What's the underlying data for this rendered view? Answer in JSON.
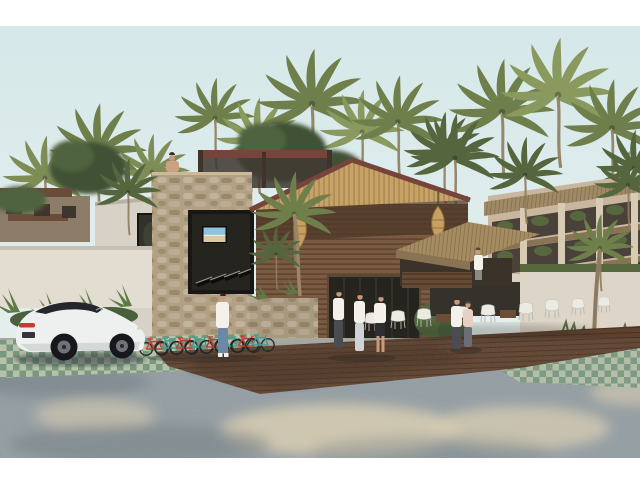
{
  "scene": {
    "type": "3d-architectural-rendering",
    "setting": "Tropical boutique hotel and condo complex amid a dense coconut palm grove",
    "elements": {
      "sky": "pale hazy blue sky",
      "vegetation": "coconut palm canopy behind and around all buildings, two broadleaf trees",
      "background_building": "multi-storey condo with thatched roof bands and planted balconies on the right",
      "gym_building": "white concrete volume on the left with tall dark glass and gym equipment visible inside",
      "stone_tower": "rough stone-clad volume with a dark picture window showing treadmills and a wall TV playing a beach scene; rooftop pergola with a seated person",
      "entrance_pavilion": "gabled palapa-style lobby with bamboo ceiling, maroon fascia, dark timber slat walls and two wicker pendant lamps",
      "terrace": "thatched palapa deck with timber railing and a standing figure",
      "dining_area": "row of white woven chairs and low tables on a timber deck",
      "car": "white Porsche 911-style coupe parked on green grass pavers",
      "bicycles": "rack of alternating red and turquoise bicycles along the stone wall",
      "people": "rooftop lounger, cyclist at the bike rack, three guests walking near the entrance, embracing couple on the deck, terrace observer",
      "ground": "grey gravel forecourt, turquoise-green grass-paver grid and chocolate timber deck with dappled tree shadows"
    },
    "counts": {
      "bicycles": 8,
      "lounge_chairs": 9,
      "people": 8,
      "cars": 1
    },
    "framing": {
      "letterbox": "white bars top and bottom",
      "content_top_px": 26,
      "content_bottom_px": 458
    }
  },
  "palette": {
    "letterbox": "#ffffff",
    "sky_top": "#d6e8ea",
    "sky_bottom": "#e9f1ee",
    "palm_light": "#8a9a5e",
    "palm_mid": "#6f7f4b",
    "palm_dark": "#55663e",
    "palm_back": "#7e8c55",
    "leaf_dark": "#3f5136",
    "leaf_mid": "#4f6340",
    "condo_wall": "#c8b69e",
    "thatch": "#a08a66",
    "thatch_dark": "#8a7352",
    "concrete": "#d8d2c6",
    "concrete_low": "#e3ddd1",
    "stone": "#b2a083",
    "stone_planter": "#a8997d",
    "glass": "#26241f",
    "gym_glass": "#33312b",
    "roof_fascia": "#76443a",
    "bamboo": "#c8a368",
    "wood_slat": "#7a5a41",
    "wood_dark": "#4e382a",
    "lamp": "#c79f5f",
    "palapa_thatch": "#a58c62",
    "deck": "#5e412d",
    "paver_light": "#b7c2a6",
    "paver_green": "#2f6a52",
    "gravel_light": "#a9aba1",
    "gravel": "#939da2",
    "gravel_shadow": "#6e7a82",
    "sand": "#dbcfb1",
    "car_body": "#eef0ef",
    "car_glass": "#23262b",
    "taillight": "#c63a33",
    "tire": "#17181b",
    "bike_red": "#c23f33",
    "bike_teal": "#3ea08f",
    "skin": "#c89a7c",
    "jeans": "#6d87a5",
    "white_cloth": "#f3f1ea",
    "dark_pants": "#4a4c52",
    "trunk": "#8f7c5c",
    "white_wall": "#ddd6c8",
    "hedge": "#57683f",
    "plant": "#5d7a45",
    "tv_sky": "#8ec4da",
    "tv_sand": "#dbc9a4"
  }
}
